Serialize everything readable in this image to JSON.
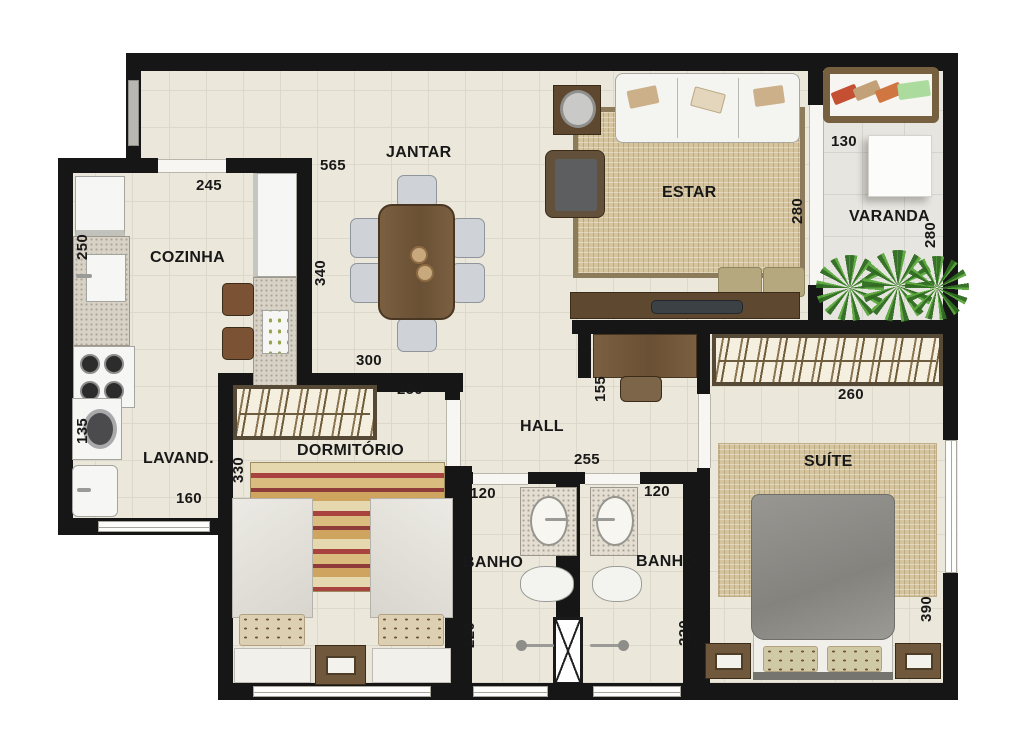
{
  "plan_title": "apartment-floor-plan",
  "rooms": {
    "cozinha": {
      "name": "COZINHA",
      "dim_width": "245",
      "dim_depth": "250"
    },
    "jantar": {
      "name": "JANTAR",
      "dim_width": "565",
      "dim_depth": "340",
      "dim_bottom": "300"
    },
    "estar": {
      "name": "ESTAR",
      "dim_depth": "280"
    },
    "varanda": {
      "name": "VARANDA",
      "dim_width": "130",
      "dim_depth": "280"
    },
    "lavanderia": {
      "name": "LAVAND.",
      "dim_depth": "135",
      "dim_width": "160"
    },
    "dormitorio": {
      "name": "DORMITÓRIO",
      "dim_width": "250",
      "dim_depth": "330"
    },
    "hall": {
      "name": "HALL",
      "dim_width": "255",
      "dim_desk": "155"
    },
    "banho_1": {
      "name": "BANHO",
      "dim_width": "120",
      "dim_depth": "220"
    },
    "banho_2": {
      "name": "BANHO",
      "dim_width": "120",
      "dim_depth": "220"
    },
    "suite": {
      "name": "SUÍTE",
      "dim_width": "260",
      "dim_depth": "390"
    }
  },
  "colors": {
    "wall": "#161616",
    "floor": "#ebe7da",
    "rug": "#d5c59e",
    "wood": "#6a5034",
    "plant": "#4f9a35"
  }
}
